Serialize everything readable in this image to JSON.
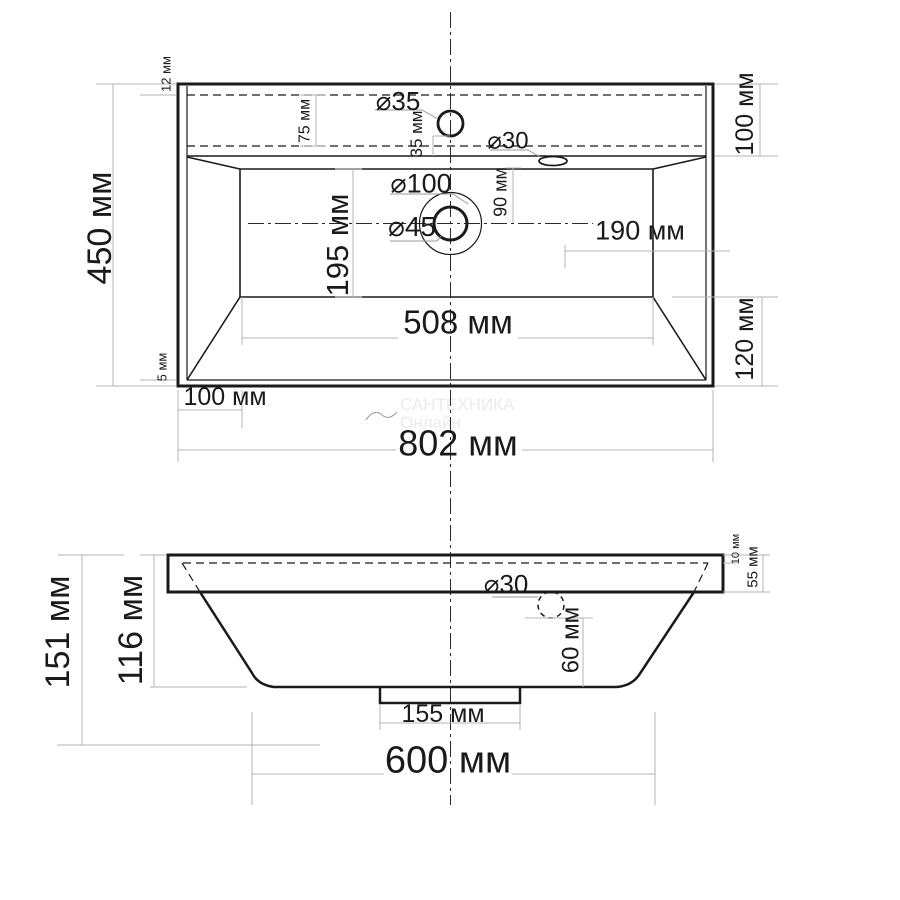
{
  "units": "мм",
  "top_view": {
    "depth": "450 мм",
    "width": "802 мм",
    "front_rim": "12 мм",
    "back_rim": "5 мм",
    "deck_band": "75 мм",
    "deck_height": "100 мм",
    "faucet_hole_dia": "⌀35",
    "faucet_hole_offset": "35 мм",
    "overflow_dia": "⌀30",
    "drain_outer_dia": "⌀100",
    "drain_inner_dia": "⌀45",
    "drain_offset": "90 мм",
    "drain_to_right": "190 мм",
    "bowl_depth": "195 мм",
    "bowl_width": "508 мм",
    "bowl_offset_left": "100 мм",
    "bowl_offset_back": "120 мм"
  },
  "front_view": {
    "total_height": "151 мм",
    "body_height": "116 мм",
    "lip": "10 мм",
    "slab_thickness": "55 мм",
    "overflow_dia": "⌀30",
    "overflow_to_bottom": "60 мм",
    "drain_stub_width": "155 мм",
    "body_width": "600 мм"
  },
  "watermark": {
    "line1": "САНТЕХНИКА",
    "line2": "Онлайн"
  }
}
